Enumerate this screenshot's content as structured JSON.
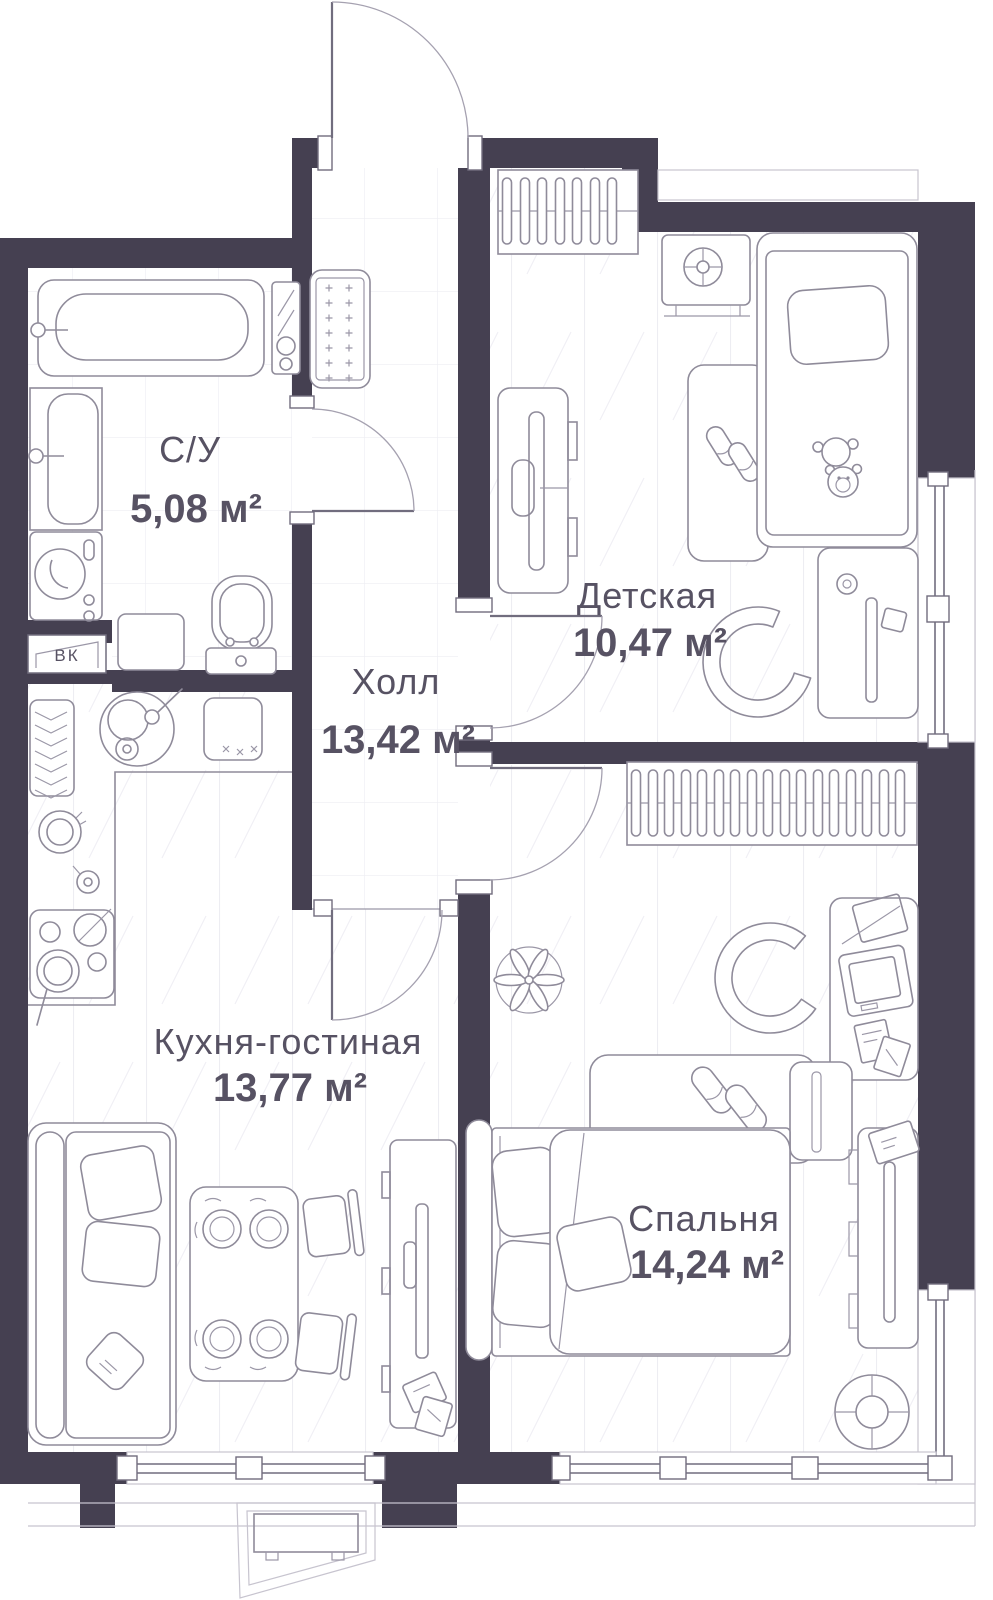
{
  "rooms": {
    "bathroom": {
      "name": "С/У",
      "area": "5,08 м²"
    },
    "hall": {
      "name": "Холл",
      "area": "13,42 м²"
    },
    "nursery": {
      "name": "Детская",
      "area": "10,47 м²"
    },
    "kitchen_living": {
      "name": "Кухня-гостиная",
      "area": "13,77 м²"
    },
    "bedroom": {
      "name": "Спальня",
      "area": "14,24 м²"
    }
  },
  "labels": {
    "vent_shaft": "ВК"
  },
  "colors": {
    "wall": "#454051",
    "furniture_line": "#8f8b9a",
    "text": "#575263",
    "floor_line": "#ededf2"
  }
}
